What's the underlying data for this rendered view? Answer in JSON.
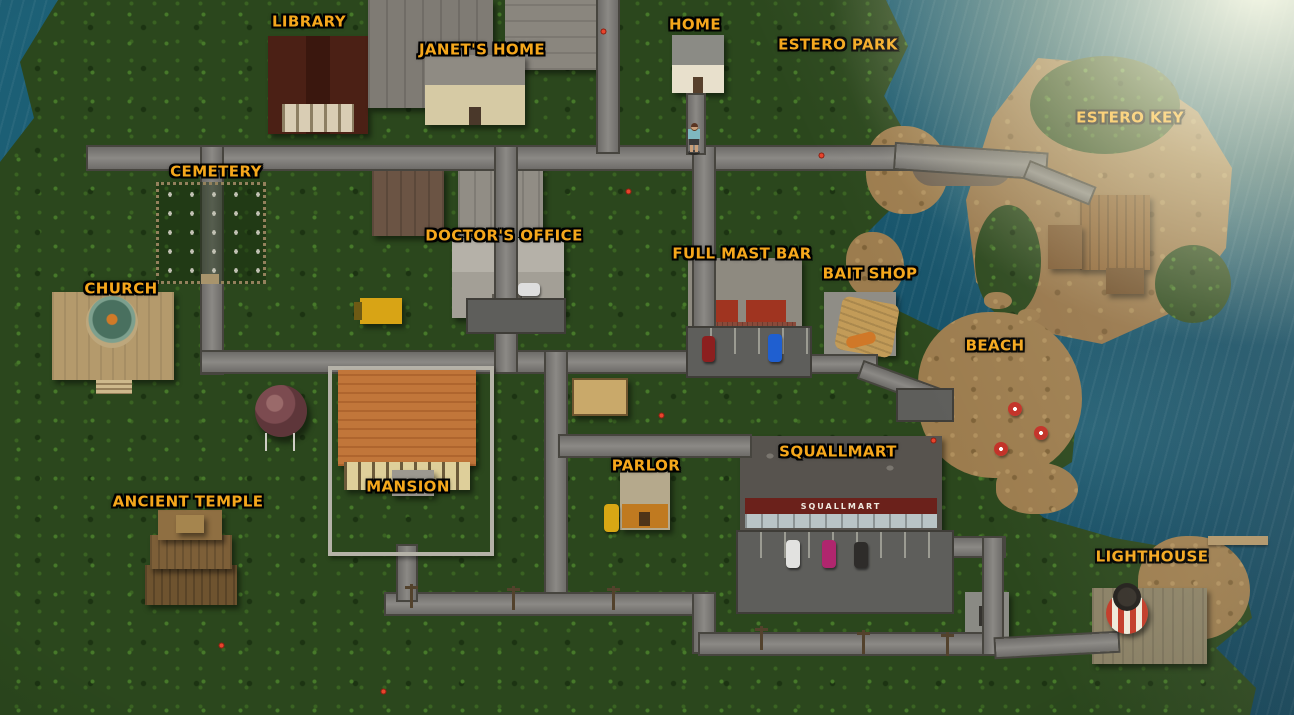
{
  "scene": {
    "name": "Town Map"
  },
  "map": {
    "locations": [
      {
        "id": "library",
        "label": "Library",
        "x": 309,
        "y": 22
      },
      {
        "id": "janets-home",
        "label": "Janet's Home",
        "x": 482,
        "y": 50
      },
      {
        "id": "home",
        "label": "Home",
        "x": 695,
        "y": 25
      },
      {
        "id": "estero-park",
        "label": "Estero Park",
        "x": 838,
        "y": 45
      },
      {
        "id": "estero-key",
        "label": "Estero Key",
        "x": 1130,
        "y": 118
      },
      {
        "id": "cemetery",
        "label": "Cemetery",
        "x": 216,
        "y": 172
      },
      {
        "id": "doctors-office",
        "label": "Doctor's Office",
        "x": 504,
        "y": 236
      },
      {
        "id": "full-mast-bar",
        "label": "Full Mast Bar",
        "x": 742,
        "y": 254
      },
      {
        "id": "bait-shop",
        "label": "Bait Shop",
        "x": 870,
        "y": 274
      },
      {
        "id": "church",
        "label": "Church",
        "x": 121,
        "y": 289
      },
      {
        "id": "beach",
        "label": "Beach",
        "x": 995,
        "y": 346
      },
      {
        "id": "squallmart",
        "label": "Squallmart",
        "x": 838,
        "y": 452
      },
      {
        "id": "parlor",
        "label": "Parlor",
        "x": 646,
        "y": 466
      },
      {
        "id": "mansion",
        "label": "Mansion",
        "x": 408,
        "y": 487
      },
      {
        "id": "ancient-temple",
        "label": "Ancient Temple",
        "x": 188,
        "y": 502
      },
      {
        "id": "lighthouse",
        "label": "Lighthouse",
        "x": 1152,
        "y": 557
      }
    ],
    "signs": {
      "squallmart_storefront": "SQUALLMART"
    },
    "colors": {
      "ocean": "#17586f",
      "jungle": "#2b471d",
      "sand": "#9c7c4e",
      "road": "#7b7977",
      "label_gold": "#f5a71c",
      "label_outline": "#000000"
    }
  }
}
